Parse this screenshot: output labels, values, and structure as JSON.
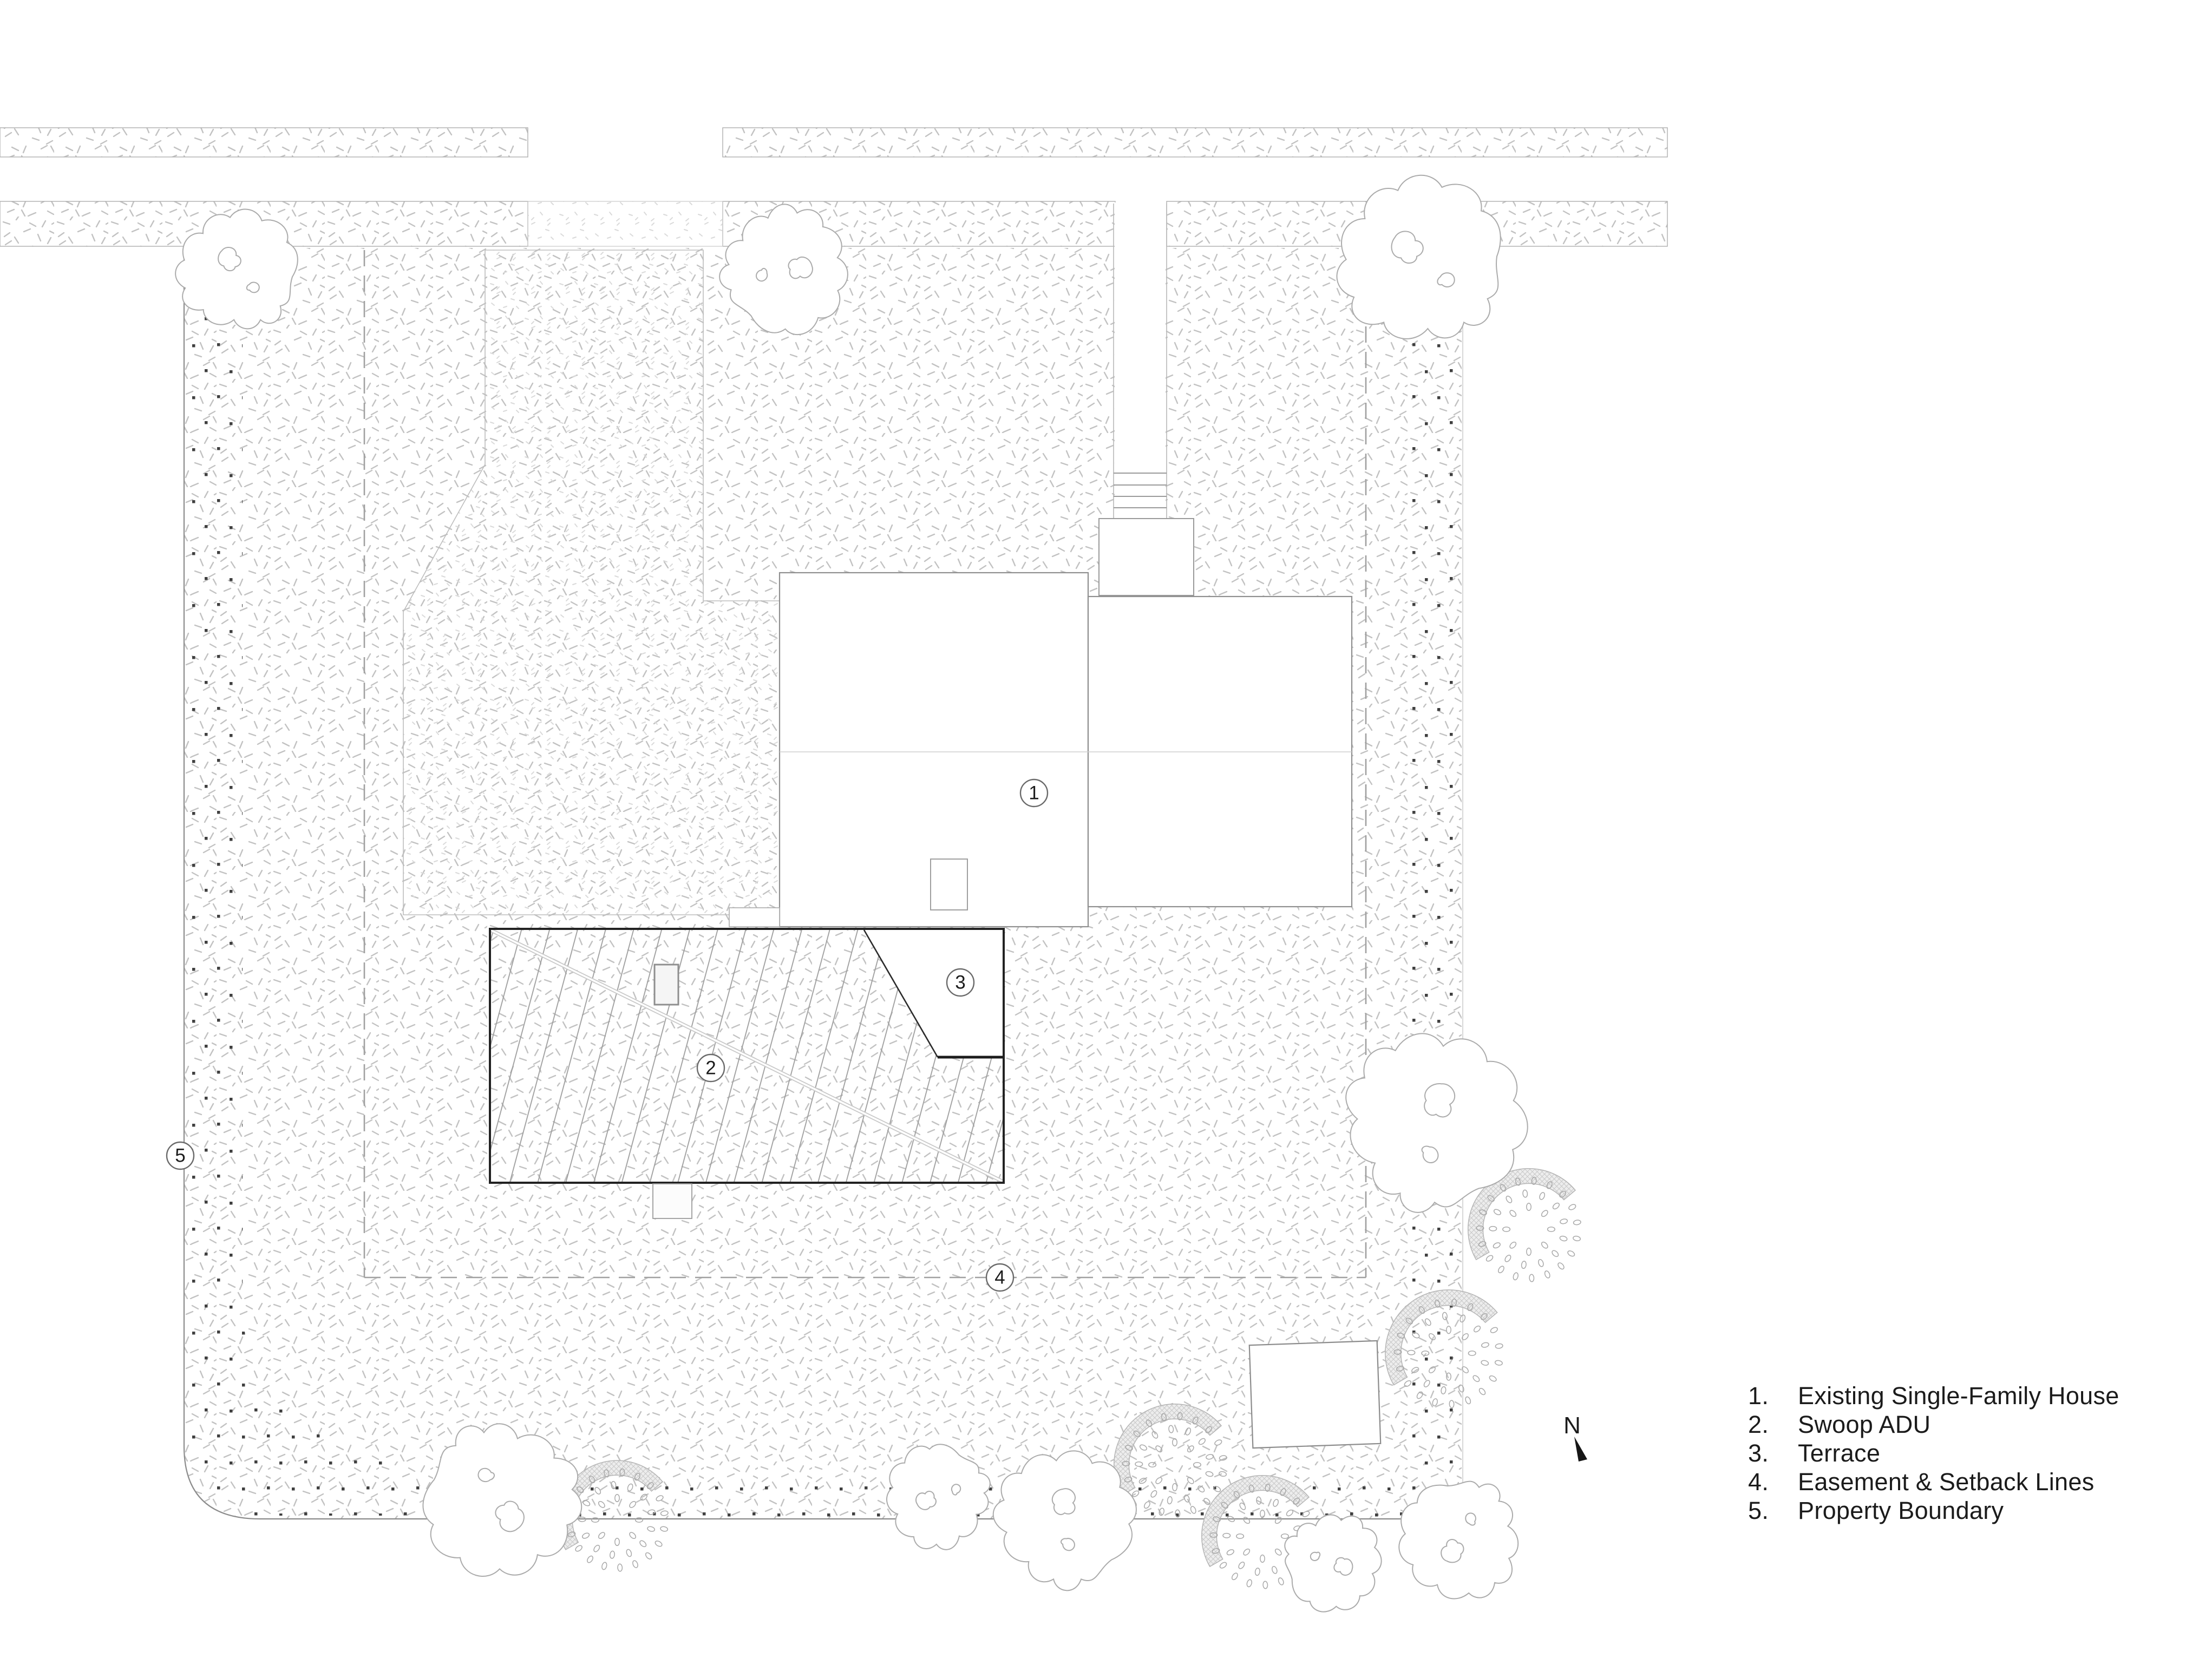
{
  "north": {
    "label": "N"
  },
  "plan": {
    "bubbles": [
      {
        "num": "1"
      },
      {
        "num": "2"
      },
      {
        "num": "3"
      },
      {
        "num": "4"
      },
      {
        "num": "5"
      }
    ]
  },
  "legend": {
    "items": [
      {
        "number": "1.",
        "label": "Existing Single-Family House"
      },
      {
        "number": "2.",
        "label": "Swoop ADU"
      },
      {
        "number": "3.",
        "label": "Terrace"
      },
      {
        "number": "4.",
        "label": "Easement & Setback Lines"
      },
      {
        "number": "5.",
        "label": "Property Boundary"
      }
    ]
  },
  "colors": {
    "paper": "#ffffff",
    "ink": "#1c1c1c",
    "light_line": "#8f8f8f",
    "adu_border": "#222222",
    "stipple": "#c2c2c2",
    "dash_line": "#a0a0a0"
  }
}
